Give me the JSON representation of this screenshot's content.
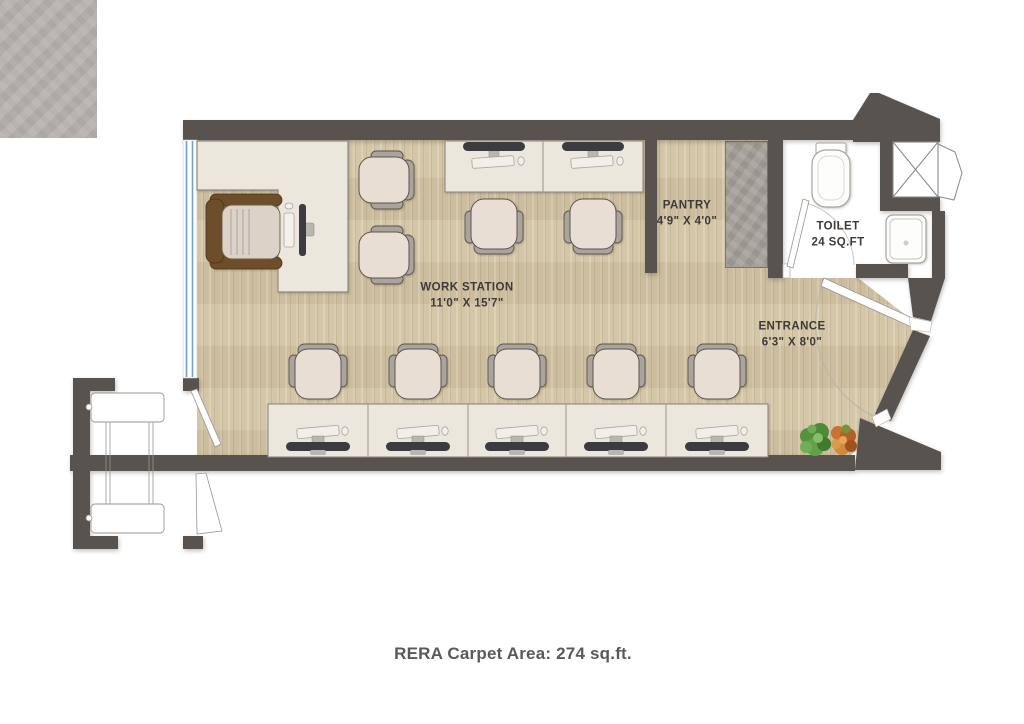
{
  "floor_plan": {
    "caption": "RERA Carpet Area: 274 sq.ft.",
    "rooms": {
      "work_station": {
        "label": "WORK STATION",
        "size": "11'0\" X 15'7\""
      },
      "pantry": {
        "label": "PANTRY",
        "size": "4'9\" X 4'0\""
      },
      "toilet": {
        "label": "TOILET",
        "size": "24 SQ.FT"
      },
      "entrance": {
        "label": "ENTRANCE",
        "size": "6'3\" X 8'0\""
      }
    },
    "fixtures": [
      "executive-desk",
      "executive-chair",
      "guest-chair",
      "workstation-desk",
      "office-chair",
      "monitor",
      "keyboard",
      "mouse",
      "pantry-counter",
      "wc",
      "washbasin",
      "duct-shaft",
      "window",
      "door",
      "plant"
    ],
    "colors": {
      "wall": "#595350",
      "wood_floor": "#d2c4a3",
      "tile_floor": "#b8b3ae",
      "counter": "#a5a19b",
      "desk": "#ece7dc",
      "chair_seat": "#e9ded4",
      "chair_frame": "#aaa49d",
      "executive_chair": "#6e4d2b",
      "window_glass": "#6fa3c8",
      "plant_green": "#55923d",
      "plant_orange": "#c8732f",
      "label_text": "#3e3a37",
      "caption_text": "#595959"
    }
  }
}
